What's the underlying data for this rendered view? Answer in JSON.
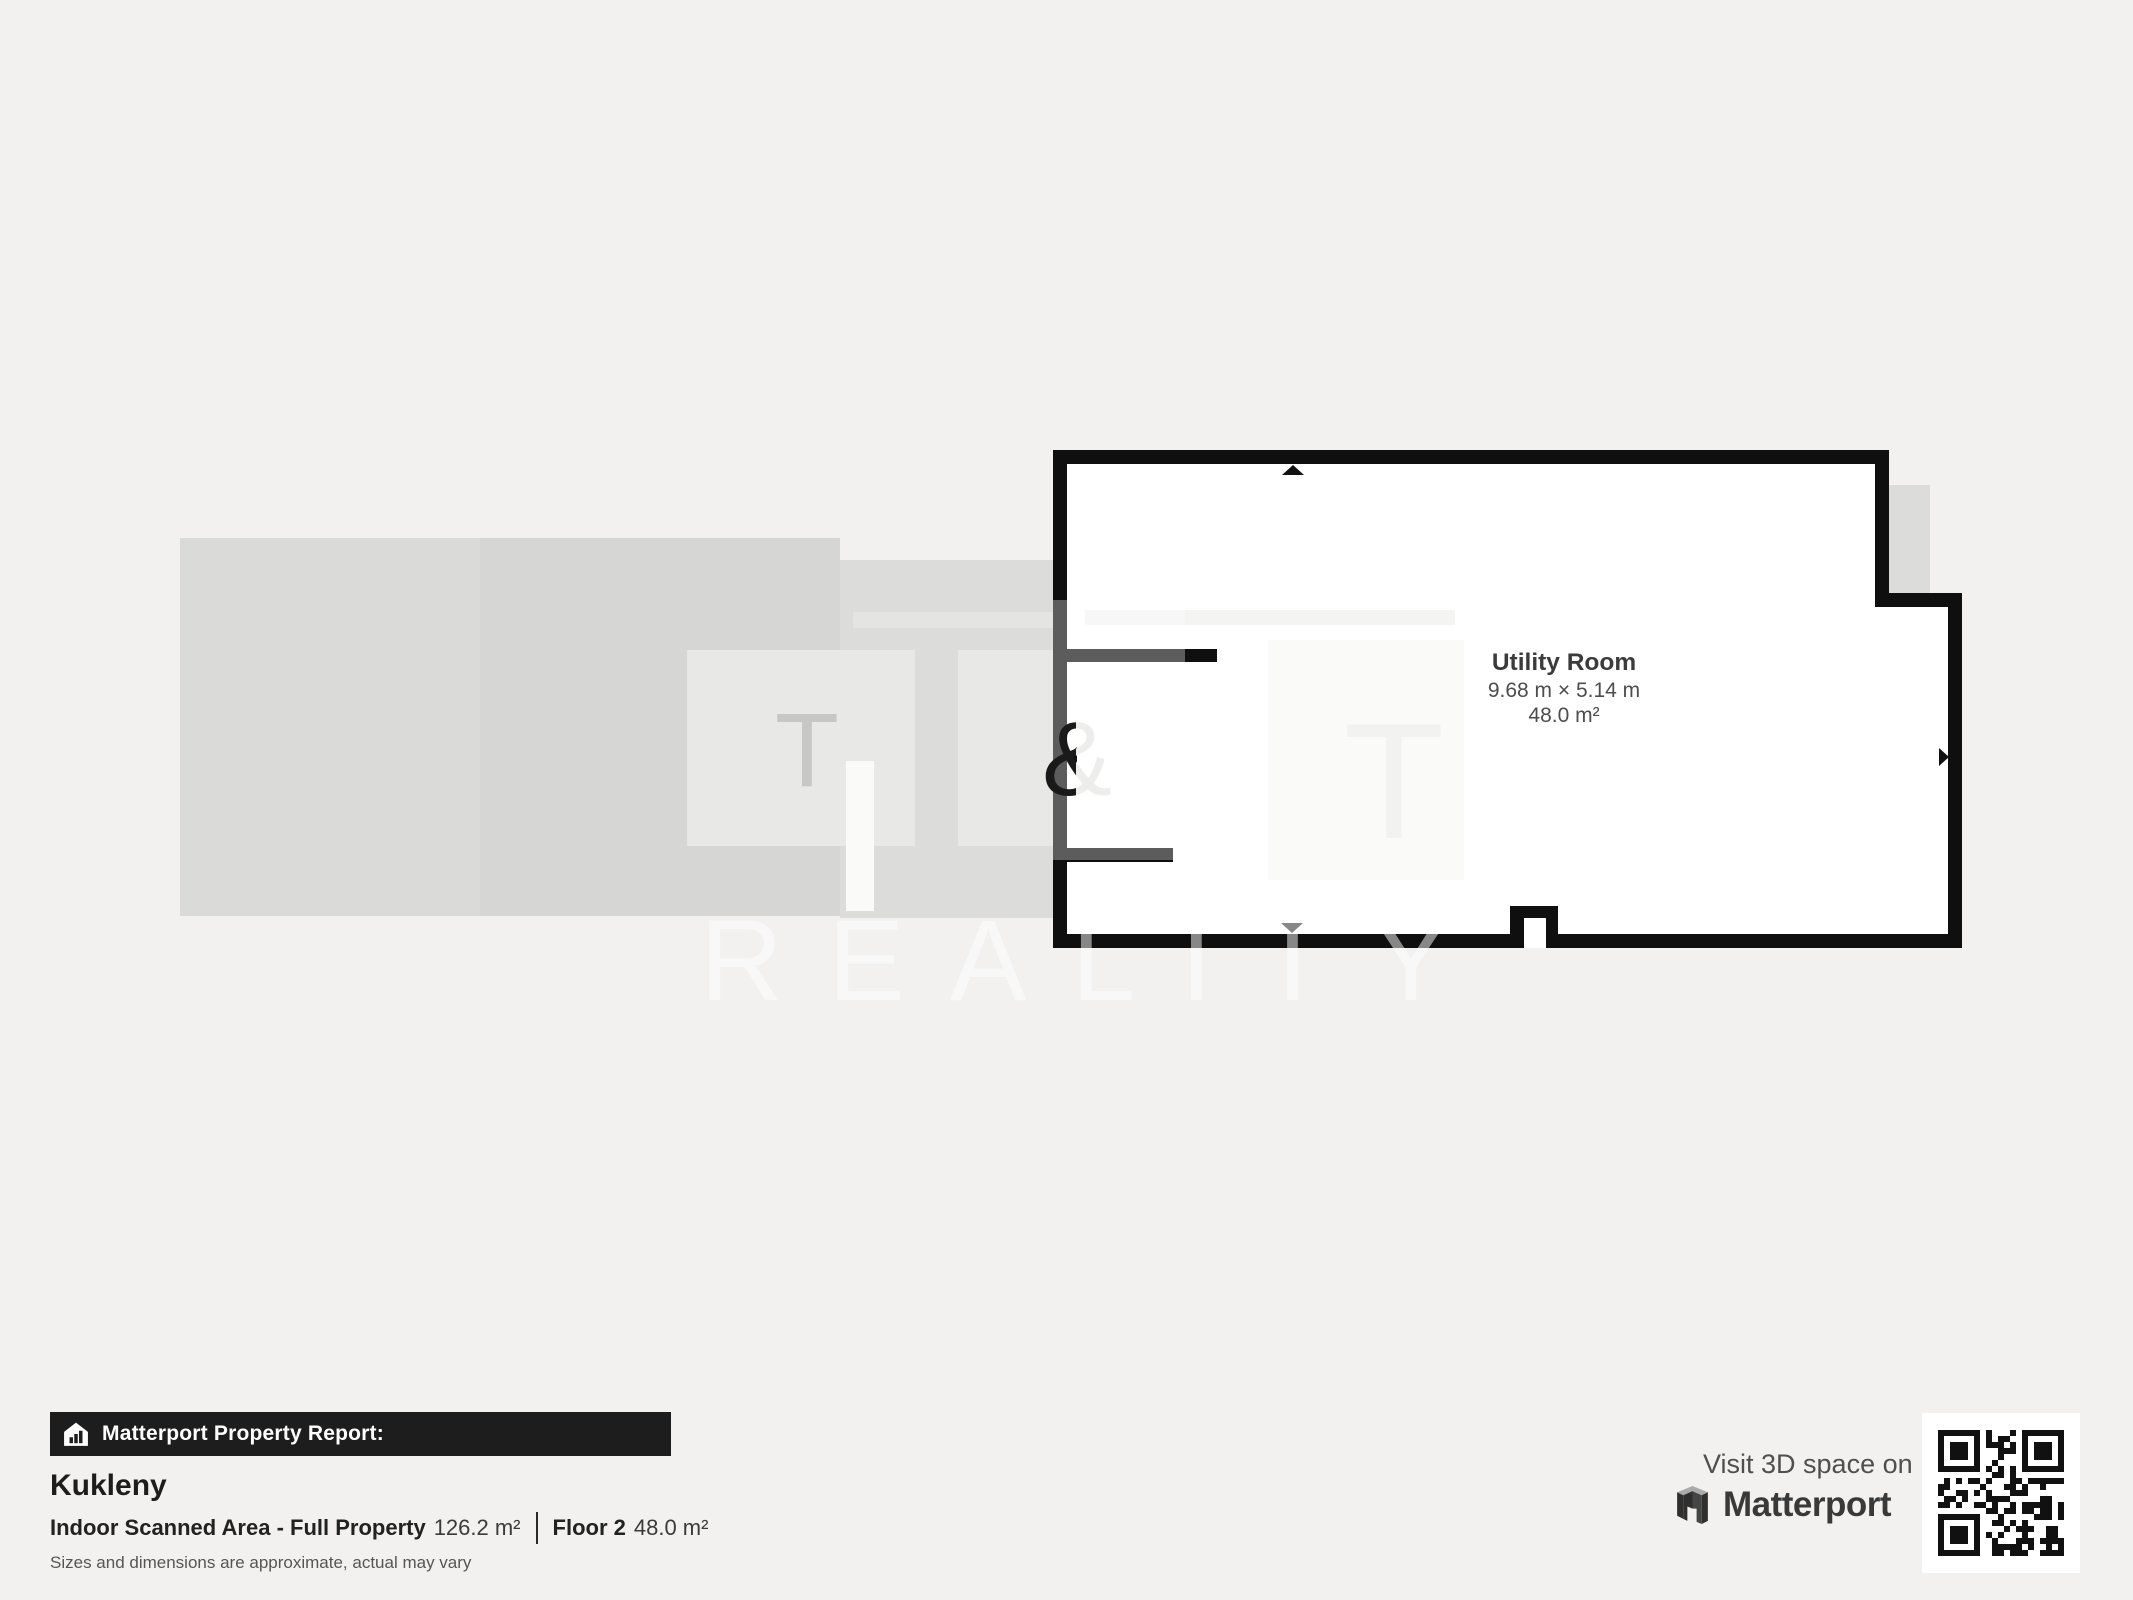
{
  "background": "#f2f1f0",
  "floorplan": {
    "room": {
      "name": "Utility Room",
      "dimensions": "9.68 m × 5.14 m",
      "area": "48.0 m²"
    },
    "wall_color": "#0f0f0f",
    "floor_color": "#ffffff"
  },
  "watermark": {
    "letter_t": "T",
    "letter_amp": "&",
    "letter_t2": "T",
    "reality": "REALITY"
  },
  "report": {
    "badge_label": "Matterport Property Report:",
    "property_name": "Kukleny",
    "area_label": "Indoor Scanned Area - Full Property",
    "area_value": "126.2 m²",
    "floor_label": "Floor 2",
    "floor_value": "48.0 m²",
    "disclaimer": "Sizes and dimensions are approximate, actual may vary"
  },
  "cta": {
    "visit": "Visit 3D space on",
    "brand": "Matterport"
  },
  "icons": {
    "badge": "house-bar-chart-icon",
    "brand": "matterport-m-icon",
    "qr": "qr-code"
  }
}
